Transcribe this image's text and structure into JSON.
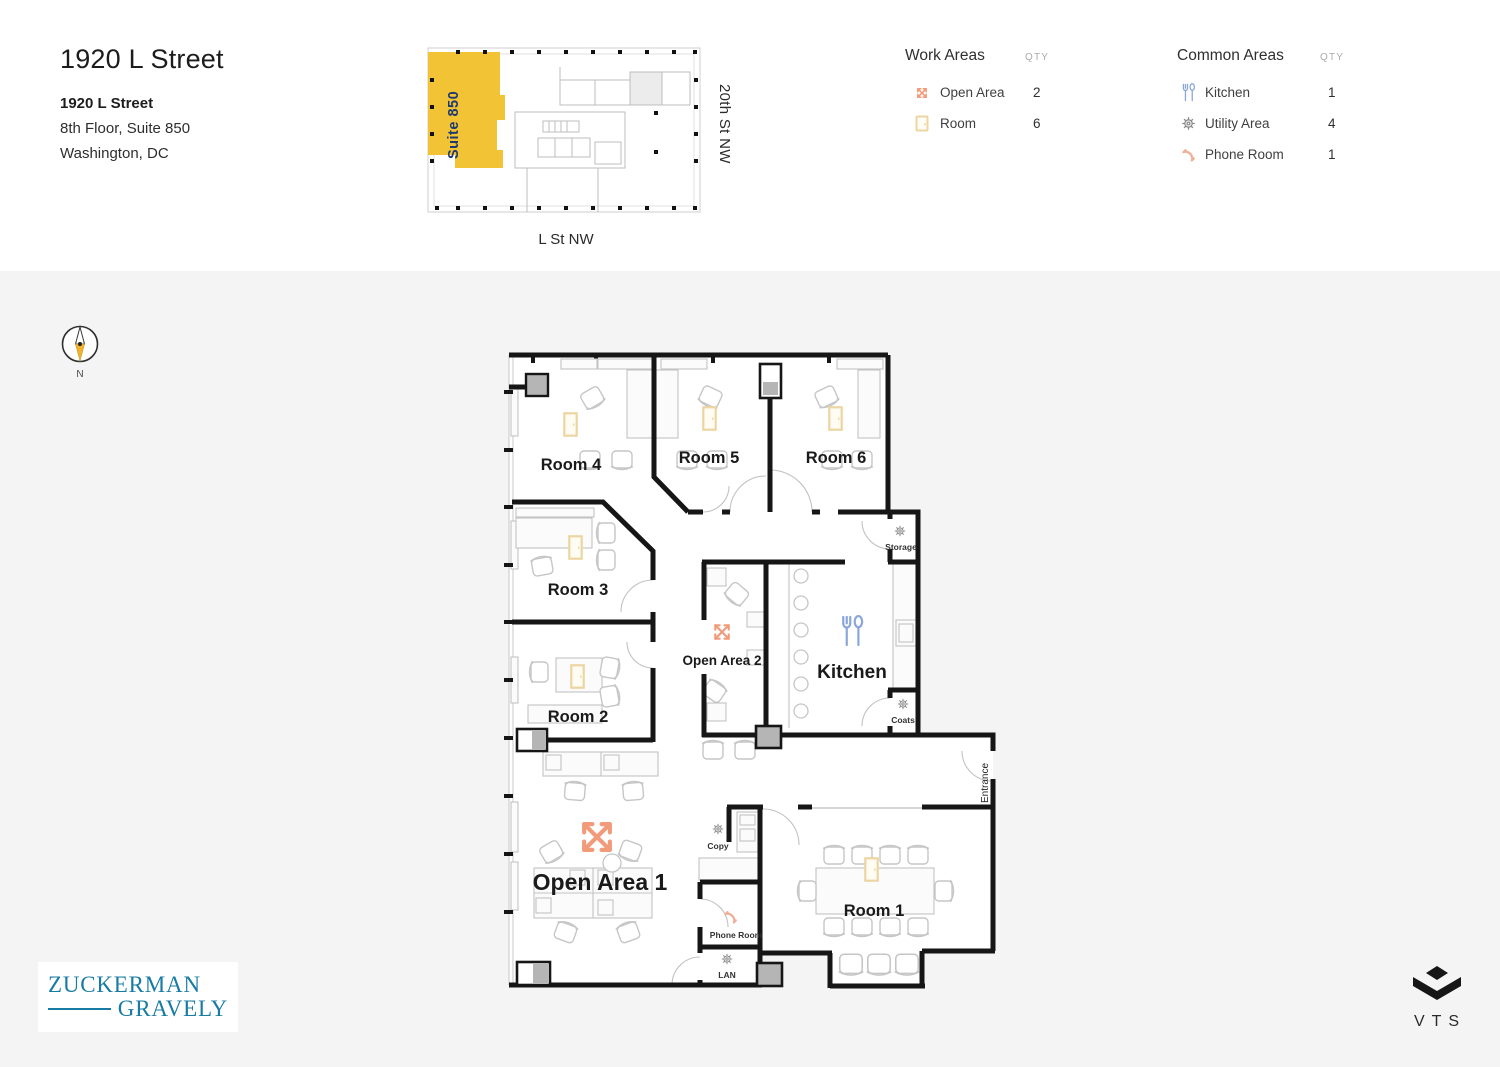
{
  "header": {
    "title": "1920 L Street",
    "building_name": "1920 L Street",
    "floor_suite": "8th Floor, Suite 850",
    "city": "Washington, DC"
  },
  "key_plan": {
    "suite_label": "Suite 850",
    "street_right": "20th St NW",
    "street_bottom": "L St NW"
  },
  "compass": {
    "north_label": "N"
  },
  "legend": {
    "work_areas": {
      "title": "Work Areas",
      "qty_label": "QTY",
      "items": [
        {
          "label": "Open Area",
          "qty": "2",
          "icon": "open-area-arrows-icon"
        },
        {
          "label": "Room",
          "qty": "6",
          "icon": "door-icon"
        }
      ]
    },
    "common_areas": {
      "title": "Common Areas",
      "qty_label": "QTY",
      "items": [
        {
          "label": "Kitchen",
          "qty": "1",
          "icon": "utensils-icon"
        },
        {
          "label": "Utility Area",
          "qty": "4",
          "icon": "gear-icon"
        },
        {
          "label": "Phone Room",
          "qty": "1",
          "icon": "phone-icon"
        }
      ]
    }
  },
  "floor_plan": {
    "labels": {
      "room1": "Room 1",
      "room2": "Room 2",
      "room3": "Room 3",
      "room4": "Room 4",
      "room5": "Room 5",
      "room6": "Room 6",
      "open_area_1": "Open Area 1",
      "open_area_2": "Open Area 2",
      "kitchen": "Kitchen",
      "storage": "Storage",
      "coats": "Coats",
      "copy": "Copy",
      "phone_room": "Phone Room",
      "lan": "LAN",
      "entrance": "Entrance"
    }
  },
  "logos": {
    "broker_line1": "ZUCKERMAN",
    "broker_line2": "GRAVELY",
    "platform": "VTS"
  },
  "colors": {
    "suite_highlight": "#F2C435",
    "accent_open_area": "#F29B7A",
    "kitchen_icon": "#8BA7D9",
    "door_icon": "#EDD5A2",
    "utility_icon": "#8D8D8D",
    "phone_icon": "#F0AE97",
    "brand_teal": "#187BA3"
  }
}
